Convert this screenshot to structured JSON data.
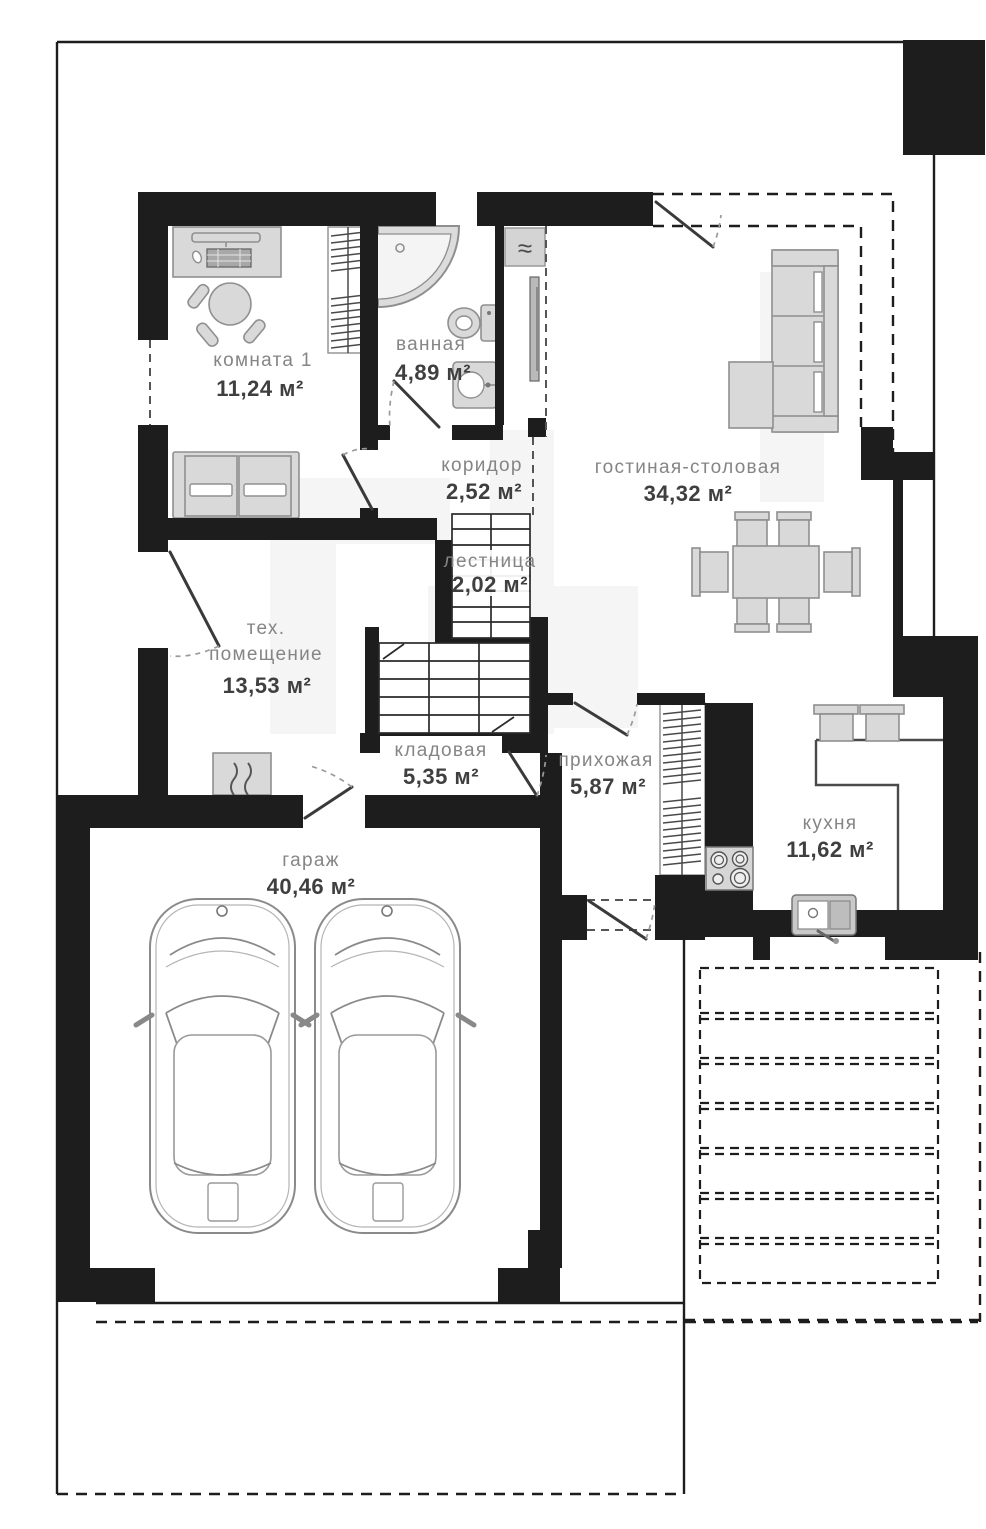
{
  "floor_plan": {
    "rooms": [
      {
        "id": "room1",
        "name": "комната 1",
        "area": "11,24 м²"
      },
      {
        "id": "bathroom",
        "name": "ванная",
        "area": "4,89 м²"
      },
      {
        "id": "corridor",
        "name": "коридор",
        "area": "2,52 м²"
      },
      {
        "id": "living_dining",
        "name": "гостиная-столовая",
        "area": "34,32 м²"
      },
      {
        "id": "stairs",
        "name": "лестница",
        "area": "2,02 м²"
      },
      {
        "id": "tech_room",
        "name_line1": "тех.",
        "name_line2": "помещение",
        "area": "13,53 м²"
      },
      {
        "id": "storage",
        "name": "кладовая",
        "area": "5,35 м²"
      },
      {
        "id": "hallway",
        "name": "прихожая",
        "area": "5,87 м²"
      },
      {
        "id": "kitchen",
        "name": "кухня",
        "area": "11,62 м²"
      },
      {
        "id": "garage",
        "name": "гараж",
        "area": "40,46 м²"
      }
    ],
    "icons": {
      "radiator": "≈"
    },
    "colors": {
      "walls": "#1d1d1d",
      "furniture": "#d9d9d9",
      "furniture_stroke": "#8f8f8f",
      "room_name_text": "#858585",
      "room_area_text": "#3f3f3f",
      "watermark": "#f5f5f5",
      "background": "#ffffff"
    }
  }
}
